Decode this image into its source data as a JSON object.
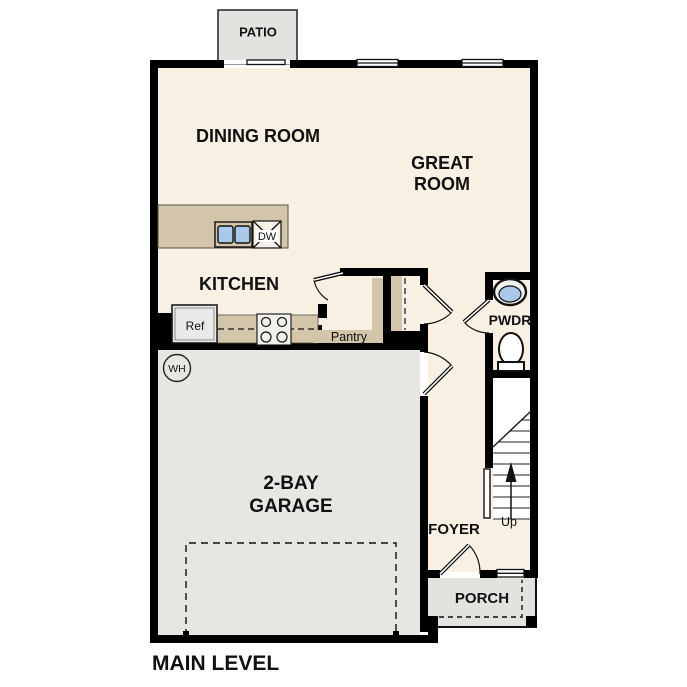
{
  "title": "MAIN LEVEL",
  "rooms": {
    "patio": "PATIO",
    "dining_room": "DINING ROOM",
    "great_room_line1": "GREAT",
    "great_room_line2": "ROOM",
    "kitchen": "KITCHEN",
    "pantry": "Pantry",
    "powder": "PWDR",
    "foyer": "FOYER",
    "porch": "PORCH",
    "garage_line1": "2-BAY",
    "garage_line2": "GARAGE"
  },
  "labels": {
    "refrigerator": "Ref",
    "dishwasher": "DW",
    "water_heater": "WH",
    "stairs_up": "Up"
  },
  "colors": {
    "floor": "#f8f1e3",
    "counter": "#d2c5a9",
    "gray_area": "#e3e2df",
    "garage_floor": "#e7e6e3",
    "sink_blue": "#aac9e9",
    "wall": "#000000"
  }
}
